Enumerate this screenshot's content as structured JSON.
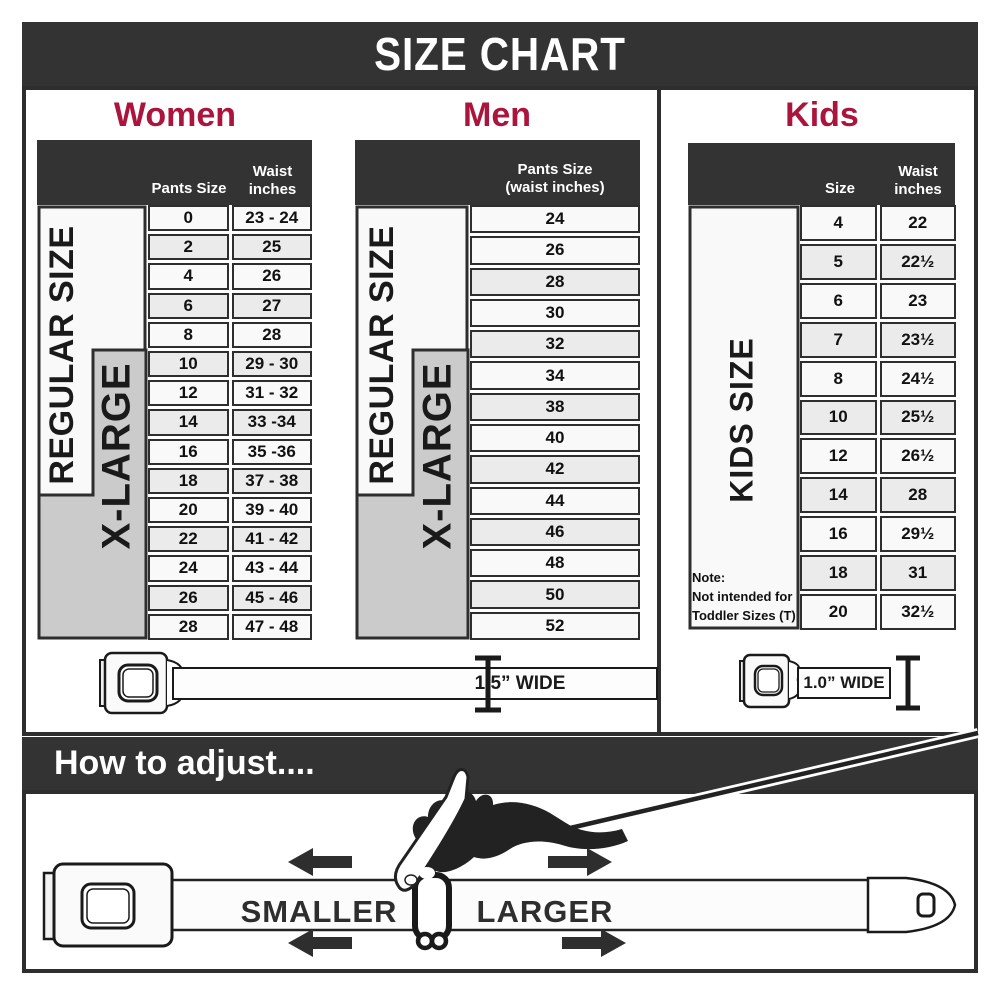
{
  "title": "SIZE CHART",
  "colors": {
    "accent_red": "#AB143C",
    "header_dark": "#333333",
    "row_light": "#f9f9f9",
    "row_alt": "#ebebeb",
    "xlarge_gray": "#cbcbcb",
    "border_dark": "#2e2e2e"
  },
  "women": {
    "heading": "Women",
    "col_pants": "Pants Size",
    "col_waist_line1": "Waist",
    "col_waist_line2": "inches",
    "regular_label": "REGULAR SIZE",
    "xlarge_label": "X-LARGE"
  },
  "men": {
    "heading": "Men",
    "col_line1": "Pants Size",
    "col_line2": "(waist inches)",
    "regular_label": "REGULAR SIZE",
    "xlarge_label": "X-LARGE"
  },
  "kids": {
    "heading": "Kids",
    "col_size": "Size",
    "col_waist_line1": "Waist",
    "col_waist_line2": "inches",
    "label": "KIDS SIZE",
    "note_line1": "Note:",
    "note_line2": "Not intended for",
    "note_line3": "Toddler Sizes (T)"
  },
  "belts": {
    "adult_width_label": "1.5” WIDE",
    "kids_width_label": "1.0” WIDE"
  },
  "adjust": {
    "heading": "How to adjust....",
    "smaller_label": "SMALLER",
    "larger_label": "LARGER"
  },
  "chart_data": [
    {
      "type": "table",
      "title": "Women",
      "columns": [
        "Pants Size",
        "Waist inches"
      ],
      "size_groups": {
        "REGULAR SIZE": "0-18",
        "X-LARGE": "10-28"
      },
      "rows": [
        [
          "0",
          "23 - 24"
        ],
        [
          "2",
          "25"
        ],
        [
          "4",
          "26"
        ],
        [
          "6",
          "27"
        ],
        [
          "8",
          "28"
        ],
        [
          "10",
          "29 - 30"
        ],
        [
          "12",
          "31 - 32"
        ],
        [
          "14",
          "33 -34"
        ],
        [
          "16",
          "35 -36"
        ],
        [
          "18",
          "37 - 38"
        ],
        [
          "20",
          "39 - 40"
        ],
        [
          "22",
          "41 - 42"
        ],
        [
          "24",
          "43 - 44"
        ],
        [
          "26",
          "45 - 46"
        ],
        [
          "28",
          "47 - 48"
        ]
      ]
    },
    {
      "type": "table",
      "title": "Men",
      "columns": [
        "Pants Size (waist inches)"
      ],
      "size_groups": {
        "REGULAR SIZE": "24-42",
        "X-LARGE": "34-52"
      },
      "rows": [
        [
          "24"
        ],
        [
          "26"
        ],
        [
          "28"
        ],
        [
          "30"
        ],
        [
          "32"
        ],
        [
          "34"
        ],
        [
          "38"
        ],
        [
          "40"
        ],
        [
          "42"
        ],
        [
          "44"
        ],
        [
          "46"
        ],
        [
          "48"
        ],
        [
          "50"
        ],
        [
          "52"
        ]
      ]
    },
    {
      "type": "table",
      "title": "Kids",
      "columns": [
        "Size",
        "Waist inches"
      ],
      "size_groups": {
        "KIDS SIZE": "4-20"
      },
      "rows": [
        [
          "4",
          "22"
        ],
        [
          "5",
          "22½"
        ],
        [
          "6",
          "23"
        ],
        [
          "7",
          "23½"
        ],
        [
          "8",
          "24½"
        ],
        [
          "10",
          "25½"
        ],
        [
          "12",
          "26½"
        ],
        [
          "14",
          "28"
        ],
        [
          "16",
          "29½"
        ],
        [
          "18",
          "31"
        ],
        [
          "20",
          "32½"
        ]
      ]
    }
  ]
}
